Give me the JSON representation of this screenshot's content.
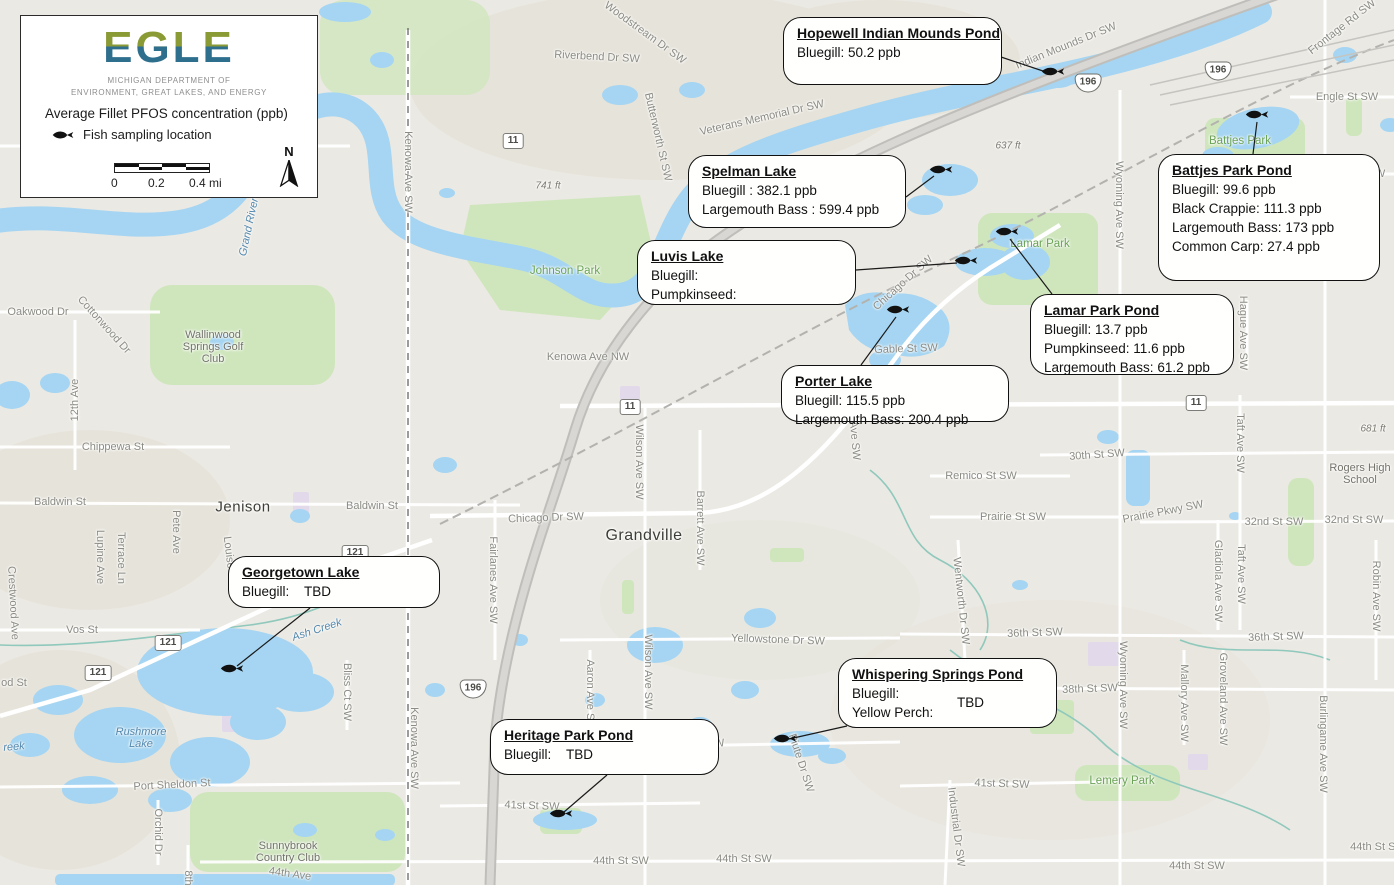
{
  "legend": {
    "logo": "EGLE",
    "logo_colors": {
      "top": "#8a9a35",
      "bottom": "#2f6f8e"
    },
    "dept_line1": "MICHIGAN DEPARTMENT OF",
    "dept_line2": "ENVIRONMENT, GREAT LAKES, AND ENERGY",
    "title": "Average Fillet PFOS concentration (ppb)",
    "sampling_label": "Fish sampling location",
    "scale_labels": [
      "0",
      "0.2",
      "0.4 mi"
    ],
    "north_label": "N"
  },
  "callouts": [
    {
      "id": "hopewell",
      "title": "Hopewell Indian Mounds Pond",
      "lines": [
        "Bluegill: 50.2 ppb"
      ],
      "box": [
        783,
        17,
        219,
        68
      ],
      "fish": [
        1053,
        74
      ],
      "leader": [
        [
          1001,
          57
        ],
        [
          1046,
          72
        ]
      ]
    },
    {
      "id": "spelman",
      "title": "Spelman Lake",
      "lines": [
        "Bluegill : 382.1 ppb",
        "Largemouth Bass : 599.4 ppb"
      ],
      "box": [
        688,
        155,
        218,
        73
      ],
      "fish": [
        941,
        172
      ],
      "leader": [
        [
          906,
          197
        ],
        [
          934,
          176
        ]
      ]
    },
    {
      "id": "luvis",
      "title": "Luvis Lake",
      "lines": [
        "Bluegill:",
        "Pumpkinseed:"
      ],
      "box": [
        637,
        240,
        219,
        65
      ],
      "fish": [
        966,
        263
      ],
      "leader": [
        [
          856,
          270
        ],
        [
          957,
          263
        ]
      ]
    },
    {
      "id": "battjes",
      "title": "Battjes Park Pond",
      "lines": [
        "Bluegill: 99.6 ppb",
        "Black Crappie: 111.3 ppb",
        "Largemouth Bass: 173 ppb",
        "Common Carp: 27.4 ppb"
      ],
      "box": [
        1158,
        154,
        222,
        127
      ],
      "fish": [
        1257,
        117
      ],
      "leader": [
        [
          1253,
          154
        ],
        [
          1257,
          122
        ]
      ]
    },
    {
      "id": "lamar",
      "title": "Lamar Park Pond",
      "lines": [
        "Bluegill: 13.7 ppb",
        "Pumpkinseed: 11.6 ppb",
        "Largemouth Bass: 61.2 ppb"
      ],
      "box": [
        1030,
        294,
        204,
        81
      ],
      "fish": [
        1007,
        234
      ],
      "leader": [
        [
          1052,
          294
        ],
        [
          1010,
          239
        ]
      ]
    },
    {
      "id": "porter",
      "title": "Porter Lake",
      "lines": [
        "Bluegill: 115.5 ppb",
        "Largemouth Bass: 200.4 ppb"
      ],
      "box": [
        781,
        365,
        228,
        57
      ],
      "fish": [
        898,
        312
      ],
      "leader": [
        [
          861,
          365
        ],
        [
          896,
          317
        ]
      ]
    },
    {
      "id": "georgetown",
      "title": "Georgetown Lake",
      "lines": [
        "Bluegill:    TBD"
      ],
      "box": [
        228,
        556,
        212,
        52
      ],
      "fish": [
        232,
        671
      ],
      "leader": [
        [
          310,
          608
        ],
        [
          237,
          666
        ]
      ]
    },
    {
      "id": "whispering",
      "title": "Whispering Springs Pond",
      "lines": [
        "Bluegill:",
        "Yellow Perch:"
      ],
      "note": "TBD",
      "note_xy": [
        118,
        36
      ],
      "box": [
        838,
        658,
        219,
        70
      ],
      "fish": [
        785,
        741
      ],
      "leader": [
        [
          847,
          726
        ],
        [
          789,
          739
        ]
      ]
    },
    {
      "id": "heritage",
      "title": "Heritage Park Pond",
      "lines": [
        "Bluegill:    TBD"
      ],
      "box": [
        490,
        719,
        229,
        56
      ],
      "fish": [
        561,
        816
      ],
      "leader": [
        [
          607,
          775
        ],
        [
          564,
          812
        ]
      ]
    }
  ],
  "map": {
    "labels": [
      {
        "t": "Woodstream Dr SW",
        "x": 645,
        "y": 33,
        "r": 36,
        "k": "street"
      },
      {
        "t": "Riverbend Dr SW",
        "x": 597,
        "y": 57,
        "r": 3,
        "k": "street"
      },
      {
        "t": "Veterans Memorial Dr SW",
        "x": 762,
        "y": 118,
        "r": -13,
        "k": "street"
      },
      {
        "t": "Burton St SW",
        "x": 272,
        "y": 146,
        "r": 0,
        "k": "street"
      },
      {
        "t": "Burton St SW",
        "x": 1352,
        "y": 174,
        "r": 0,
        "k": "street"
      },
      {
        "t": "Kenowa Ave SW",
        "x": 408,
        "y": 172,
        "r": 90,
        "k": "street"
      },
      {
        "t": "Butterworth St SW",
        "x": 658,
        "y": 137,
        "r": 77,
        "k": "street"
      },
      {
        "t": "Indian Mounds Dr SW",
        "x": 1066,
        "y": 46,
        "r": -22,
        "k": "street"
      },
      {
        "t": "Frontage Rd SW",
        "x": 1342,
        "y": 27,
        "r": -38,
        "k": "street"
      },
      {
        "t": "Engle St SW",
        "x": 1347,
        "y": 97,
        "r": 0,
        "k": "street"
      },
      {
        "t": "Wyoming Ave SW",
        "x": 1119,
        "y": 205,
        "r": 90,
        "k": "street"
      },
      {
        "t": "Wyoming Ave SW",
        "x": 1123,
        "y": 685,
        "r": 90,
        "k": "street"
      },
      {
        "t": "Hague Ave SW",
        "x": 1243,
        "y": 333,
        "r": 90,
        "k": "street"
      },
      {
        "t": "Kenowa Ave NW",
        "x": 588,
        "y": 357,
        "r": 0,
        "k": "street"
      },
      {
        "t": "Oakwood Dr",
        "x": 38,
        "y": 312,
        "r": 0,
        "k": "street"
      },
      {
        "t": "Cottonwood Dr",
        "x": 104,
        "y": 325,
        "r": 48,
        "k": "street"
      },
      {
        "t": "12th Ave",
        "x": 75,
        "y": 400,
        "r": -90,
        "k": "street"
      },
      {
        "t": "Chippewa St",
        "x": 113,
        "y": 447,
        "r": 0,
        "k": "street"
      },
      {
        "t": "Baldwin St",
        "x": 60,
        "y": 502,
        "r": 0,
        "k": "street"
      },
      {
        "t": "Baldwin St",
        "x": 372,
        "y": 506,
        "r": 0,
        "k": "street"
      },
      {
        "t": "Pete Ave",
        "x": 176,
        "y": 532,
        "r": 90,
        "k": "street"
      },
      {
        "t": "Louise Ave",
        "x": 230,
        "y": 563,
        "r": 83,
        "k": "street"
      },
      {
        "t": "Terrace Ln",
        "x": 121,
        "y": 558,
        "r": 90,
        "k": "street"
      },
      {
        "t": "Lupine Ave",
        "x": 100,
        "y": 557,
        "r": 90,
        "k": "street"
      },
      {
        "t": "Vos St",
        "x": 82,
        "y": 630,
        "r": 0,
        "k": "street"
      },
      {
        "t": "Crestwood Ave",
        "x": 13,
        "y": 603,
        "r": 87,
        "k": "street"
      },
      {
        "t": "od St",
        "x": 14,
        "y": 683,
        "r": 0,
        "k": "street"
      },
      {
        "t": "Port Sheldon St",
        "x": 172,
        "y": 785,
        "r": -3,
        "k": "street"
      },
      {
        "t": "Orchid Dr",
        "x": 158,
        "y": 832,
        "r": 90,
        "k": "street"
      },
      {
        "t": "8th",
        "x": 188,
        "y": 878,
        "r": 90,
        "k": "street"
      },
      {
        "t": "44th Ave",
        "x": 290,
        "y": 874,
        "r": 8,
        "k": "street"
      },
      {
        "t": "41st St SW",
        "x": 532,
        "y": 806,
        "r": 2,
        "k": "street"
      },
      {
        "t": "41st St SW",
        "x": 1002,
        "y": 784,
        "r": 2,
        "k": "street"
      },
      {
        "t": "Kenowa Ave SW",
        "x": 414,
        "y": 748,
        "r": 90,
        "k": "street"
      },
      {
        "t": "Bliss Ct SW",
        "x": 347,
        "y": 692,
        "r": 90,
        "k": "street"
      },
      {
        "t": "Aaron Ave SW",
        "x": 590,
        "y": 695,
        "r": 90,
        "k": "street"
      },
      {
        "t": "Wilson Ave SW",
        "x": 639,
        "y": 462,
        "r": 90,
        "k": "street"
      },
      {
        "t": "Wilson Ave SW",
        "x": 648,
        "y": 672,
        "r": 90,
        "k": "street"
      },
      {
        "t": "Barrett Ave SW",
        "x": 700,
        "y": 528,
        "r": 90,
        "k": "street"
      },
      {
        "t": "Fairlanes Ave SW",
        "x": 493,
        "y": 580,
        "r": 90,
        "k": "street"
      },
      {
        "t": "Yellowstone Dr SW",
        "x": 778,
        "y": 640,
        "r": 2,
        "k": "street"
      },
      {
        "t": "Chicago Dr SW",
        "x": 546,
        "y": 518,
        "r": -2,
        "k": "street"
      },
      {
        "t": "Chicago Dr SW",
        "x": 903,
        "y": 283,
        "r": -42,
        "k": "street"
      },
      {
        "t": "Gable St SW",
        "x": 906,
        "y": 349,
        "r": -2,
        "k": "street"
      },
      {
        "t": "Forrest Ave SW",
        "x": 853,
        "y": 422,
        "r": 85,
        "k": "street"
      },
      {
        "t": "Wentworth Dr SW",
        "x": 961,
        "y": 601,
        "r": 84,
        "k": "street"
      },
      {
        "t": "36th St SW",
        "x": 1035,
        "y": 633,
        "r": -2,
        "k": "street"
      },
      {
        "t": "36th St SW",
        "x": 1276,
        "y": 637,
        "r": -2,
        "k": "street"
      },
      {
        "t": "38th St SW",
        "x": 1090,
        "y": 689,
        "r": -2,
        "k": "street"
      },
      {
        "t": "40th St SW",
        "x": 697,
        "y": 747,
        "r": -8,
        "k": "street"
      },
      {
        "t": "30th St SW",
        "x": 1097,
        "y": 455,
        "r": -4,
        "k": "street"
      },
      {
        "t": "Remico St SW",
        "x": 981,
        "y": 476,
        "r": 0,
        "k": "street"
      },
      {
        "t": "Prairie St SW",
        "x": 1013,
        "y": 517,
        "r": 0,
        "k": "street"
      },
      {
        "t": "Prairie Pkwy SW",
        "x": 1163,
        "y": 512,
        "r": -11,
        "k": "street"
      },
      {
        "t": "32nd St SW",
        "x": 1274,
        "y": 522,
        "r": 0,
        "k": "street"
      },
      {
        "t": "32nd St SW",
        "x": 1354,
        "y": 520,
        "r": 0,
        "k": "street"
      },
      {
        "t": "Taft Ave SW",
        "x": 1240,
        "y": 443,
        "r": 90,
        "k": "street"
      },
      {
        "t": "Taft Ave SW",
        "x": 1241,
        "y": 574,
        "r": 90,
        "k": "street"
      },
      {
        "t": "Gladiola Ave SW",
        "x": 1218,
        "y": 581,
        "r": 90,
        "k": "street"
      },
      {
        "t": "Robin Ave SW",
        "x": 1376,
        "y": 596,
        "r": 90,
        "k": "street"
      },
      {
        "t": "Mallory Ave SW",
        "x": 1184,
        "y": 703,
        "r": 90,
        "k": "street"
      },
      {
        "t": "Groveland Ave SW",
        "x": 1223,
        "y": 699,
        "r": 90,
        "k": "street"
      },
      {
        "t": "Burlingame Ave SW",
        "x": 1323,
        "y": 744,
        "r": 90,
        "k": "street"
      },
      {
        "t": "Industrial Dr SW",
        "x": 956,
        "y": 827,
        "r": 83,
        "k": "street"
      },
      {
        "t": "Piute Dr SW",
        "x": 801,
        "y": 763,
        "r": 72,
        "k": "street"
      },
      {
        "t": "44th St SW",
        "x": 621,
        "y": 861,
        "r": 0,
        "k": "street"
      },
      {
        "t": "44th St SW",
        "x": 744,
        "y": 859,
        "r": 0,
        "k": "street"
      },
      {
        "t": "44th St SW",
        "x": 1197,
        "y": 866,
        "r": 0,
        "k": "street"
      },
      {
        "t": "44th St SW",
        "x": 1378,
        "y": 847,
        "r": 0,
        "k": "street"
      },
      {
        "t": "Jenison",
        "x": 243,
        "y": 507,
        "r": 0,
        "k": "city",
        "s": 15
      },
      {
        "t": "Grandville",
        "x": 644,
        "y": 536,
        "r": 0,
        "k": "city",
        "s": 16
      },
      {
        "t": "Johnson Park",
        "x": 565,
        "y": 271,
        "r": 0,
        "k": "park"
      },
      {
        "t": "Battjes Park",
        "x": 1240,
        "y": 141,
        "r": 0,
        "k": "park"
      },
      {
        "t": "Lamar Park",
        "x": 1040,
        "y": 244,
        "r": 0,
        "k": "park"
      },
      {
        "t": "Lemery Park",
        "x": 1122,
        "y": 781,
        "r": 0,
        "k": "park"
      },
      {
        "t": "Wallinwood\nSprings Golf\nClub",
        "x": 213,
        "y": 347,
        "r": 0,
        "k": "poi"
      },
      {
        "t": "Sunnybrook\nCountry Club",
        "x": 288,
        "y": 852,
        "r": 0,
        "k": "poi"
      },
      {
        "t": "Rogers High\nSchool",
        "x": 1360,
        "y": 474,
        "r": 0,
        "k": "poi"
      },
      {
        "t": "Grand River",
        "x": 249,
        "y": 227,
        "r": -78,
        "k": "water"
      },
      {
        "t": "Rushmore\nLake",
        "x": 141,
        "y": 738,
        "r": 0,
        "k": "water"
      },
      {
        "t": "Ash Creek",
        "x": 317,
        "y": 630,
        "r": -18,
        "k": "water"
      },
      {
        "t": "reek",
        "x": 14,
        "y": 747,
        "r": -5,
        "k": "water"
      },
      {
        "t": "741 ft",
        "x": 548,
        "y": 186,
        "r": 0,
        "k": "elev"
      },
      {
        "t": "637 ft",
        "x": 1008,
        "y": 146,
        "r": 0,
        "k": "elev"
      },
      {
        "t": "681 ft",
        "x": 1373,
        "y": 429,
        "r": 0,
        "k": "elev"
      }
    ],
    "shields": [
      {
        "label": "196",
        "type": "interstate",
        "x": 1088,
        "y": 83
      },
      {
        "label": "196",
        "type": "interstate",
        "x": 1218,
        "y": 71
      },
      {
        "label": "196",
        "type": "interstate",
        "x": 473,
        "y": 689
      },
      {
        "label": "11",
        "type": "state",
        "x": 513,
        "y": 141
      },
      {
        "label": "11",
        "type": "state",
        "x": 630,
        "y": 407
      },
      {
        "label": "11",
        "type": "state",
        "x": 1196,
        "y": 403
      },
      {
        "label": "121",
        "type": "state",
        "x": 355,
        "y": 553
      },
      {
        "label": "121",
        "type": "state",
        "x": 168,
        "y": 643
      },
      {
        "label": "121",
        "type": "state",
        "x": 98,
        "y": 673
      }
    ]
  }
}
